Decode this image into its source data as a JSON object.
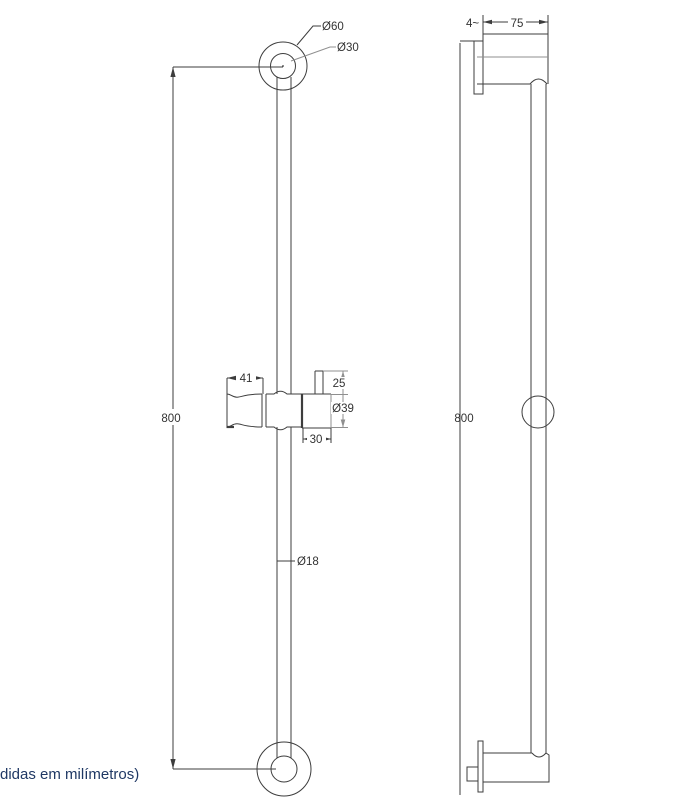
{
  "caption": "didas em milímetros)",
  "colors": {
    "line_dark": "#3d3d3d",
    "line_gray": "#8f8f8f",
    "text": "#333333",
    "caption_text": "#1f3864"
  },
  "front_view": {
    "labels": {
      "top_outer_diameter": "Ø60",
      "top_inner_diameter": "Ø30",
      "height": "800",
      "holder_width": "41",
      "tab_height": "25",
      "knob_diameter": "Ø39",
      "knob_width": "30",
      "bar_diameter": "Ø18"
    }
  },
  "side_view": {
    "labels": {
      "flange_thickness": "4~",
      "wall_projection": "75",
      "height": "800"
    }
  }
}
